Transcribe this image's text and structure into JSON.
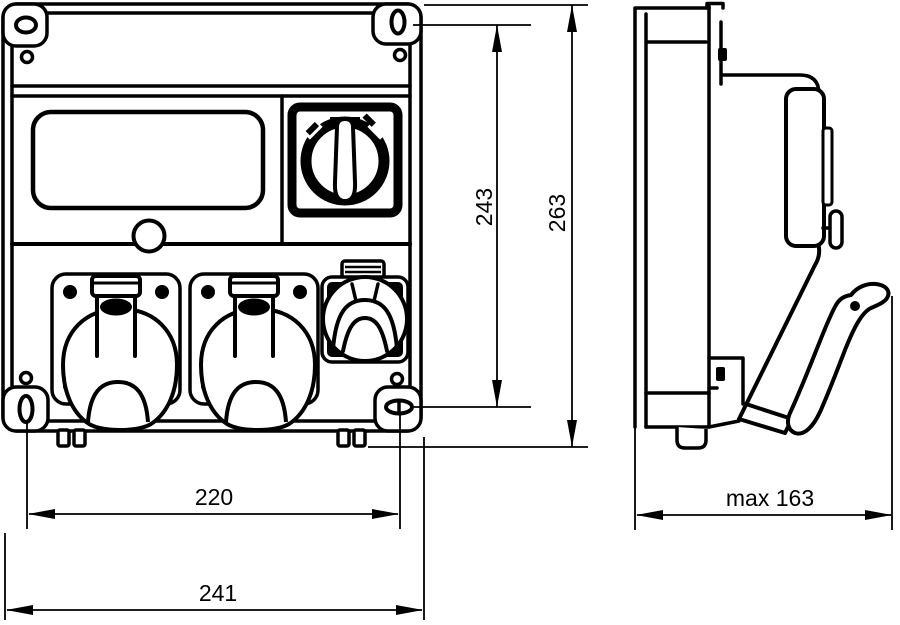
{
  "meta": {
    "type": "technical-dimension-drawing",
    "subject": "wall-mounted distribution box with sockets, front and side views",
    "colors": {
      "line": "#000000",
      "background": "#ffffff"
    }
  },
  "dimensions": {
    "mounting_height": "243",
    "overall_height": "263",
    "mounting_width": "220",
    "overall_width": "241",
    "max_depth": "max 163"
  }
}
